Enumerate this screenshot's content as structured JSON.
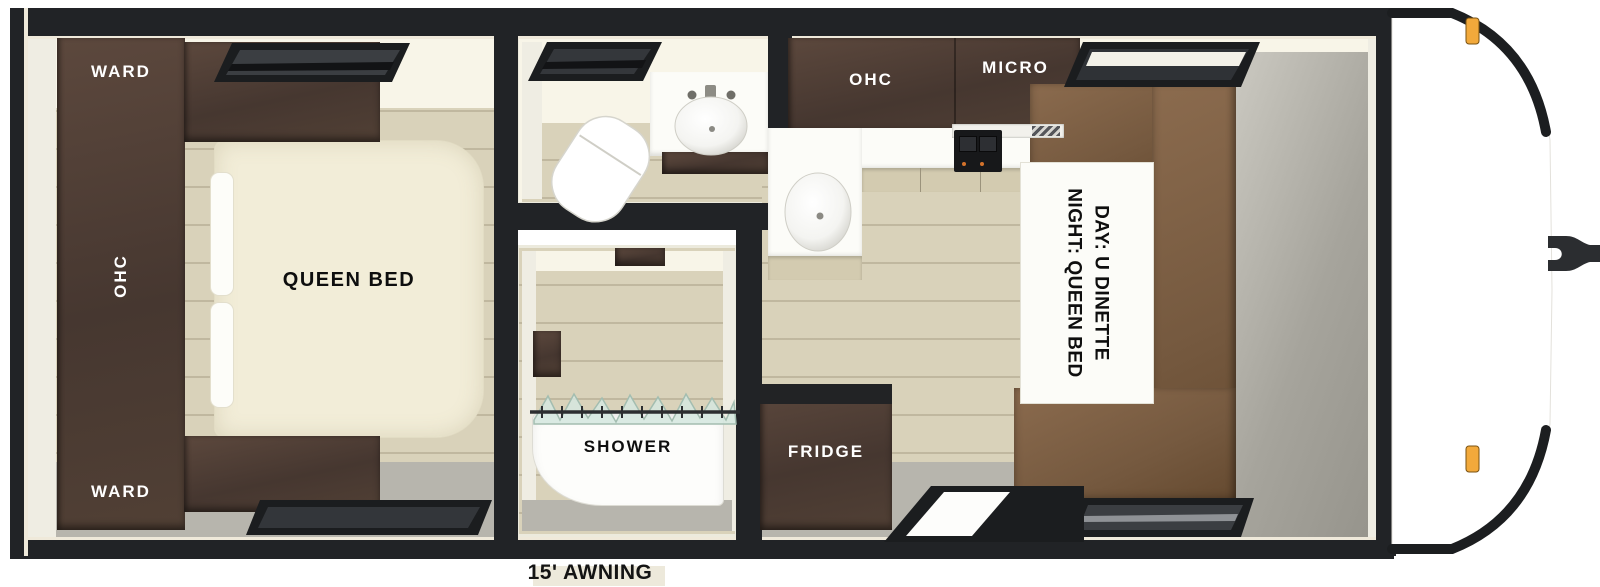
{
  "floorplan": {
    "bedroom": {
      "ward_top": "WARD",
      "ohc": "OHC",
      "ward_bottom": "WARD",
      "bed": "QUEEN BED"
    },
    "shower": {
      "label": "SHOWER"
    },
    "kitchen": {
      "ohc": "OHC",
      "micro": "MICRO",
      "fridge": "FRIDGE"
    },
    "dinette": {
      "day": "DAY: U DINETTE",
      "night": "NIGHT: QUEEN BED"
    },
    "exterior": {
      "awning": "15' AWNING"
    },
    "colors": {
      "wall_black": "#212326",
      "cabinet_dark_wood": "#4b3b32",
      "bench_brown": "#7d5e45",
      "floor_wood": "#d9d2ba",
      "floor_gray": "#b7b5ad",
      "ceiling_cream": "#f8f5e8",
      "fixture_white": "#fdfdfb",
      "marker_light_amber": "#f2a93b"
    }
  }
}
